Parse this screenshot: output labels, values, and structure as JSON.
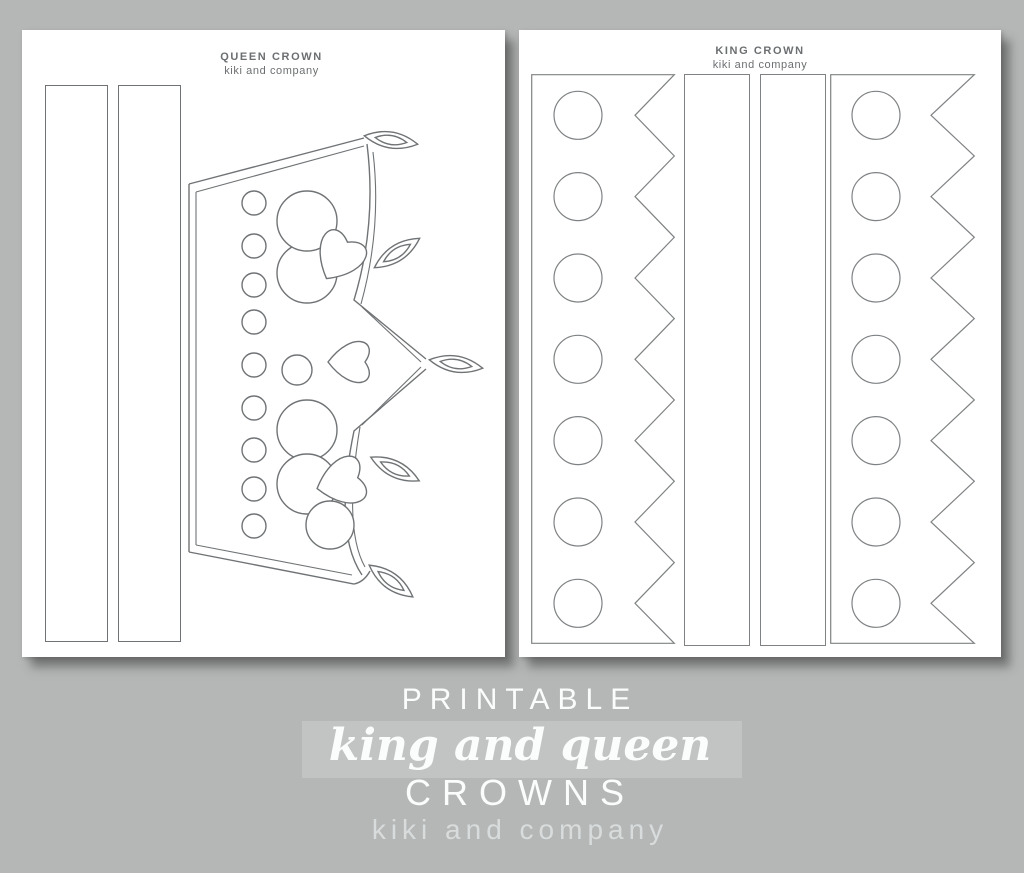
{
  "canvas": {
    "width": 1024,
    "height": 873,
    "background_color": "#b5b7b7",
    "highlight_band_color": "#c2c4c4"
  },
  "pages": [
    {
      "name": "queen-crown-page",
      "title": "QUEEN CROWN",
      "subtitle": "kiki and company",
      "pieces": [
        "headband-strip",
        "headband-strip",
        "queen-crown-template"
      ]
    },
    {
      "name": "king-crown-page",
      "title": "KING CROWN",
      "subtitle": "kiki and company",
      "pieces": [
        "king-crown-band-with-circles-and-zigzag",
        "headband-strip",
        "headband-strip",
        "king-crown-band-with-circles-and-zigzag"
      ]
    }
  ],
  "footer": {
    "line1": "PRINTABLE",
    "line2": "king and queen",
    "line3": "CROWNS",
    "line4": "kiki and company"
  },
  "colors": {
    "queen_template_line": "#707375",
    "king_template_line": "#7f8284",
    "page_title_text": "#6c6f71",
    "footer_bright_text": "#fbfcfc",
    "footer_muted_text": "#d9dcdc"
  }
}
